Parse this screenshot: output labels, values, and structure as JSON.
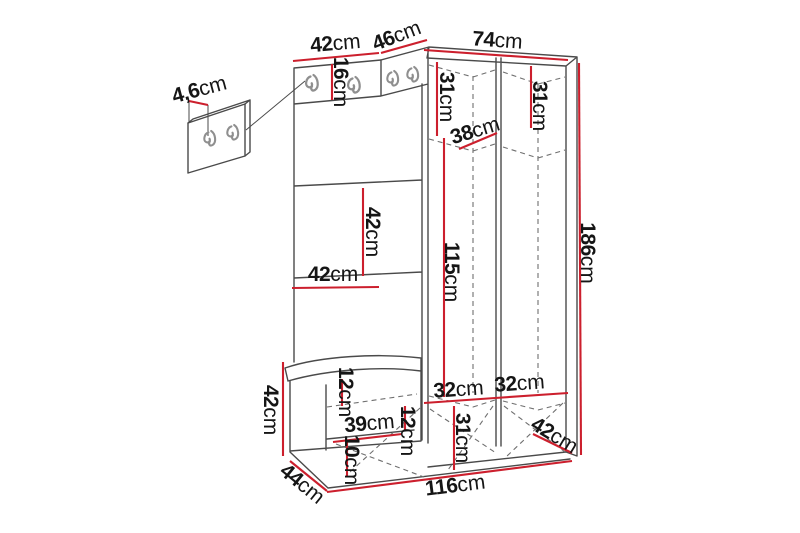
{
  "colors": {
    "dim_line": "#cc1f2d",
    "outline": "#4a4a4a",
    "dashed": "#6f6f6f",
    "hook": "#8f8f8f",
    "text": "#151515",
    "background": "#ffffff"
  },
  "diagram": {
    "type": "furniture-dimension-drawing",
    "subject": "hallway wardrobe set with coat hooks, shelves, bench and wall hook panel",
    "unit": "cm",
    "dims": {
      "top_width_left": {
        "v": "42",
        "u": "cm"
      },
      "top_width_corner": {
        "v": "46",
        "u": "cm"
      },
      "top_width_right": {
        "v": "74",
        "u": "cm"
      },
      "panel_thickness": {
        "v": "4,6",
        "u": "cm"
      },
      "hook_strip_height": {
        "v": "16",
        "u": "cm"
      },
      "upper_section_left": {
        "v": "31",
        "u": "cm"
      },
      "upper_section_right": {
        "v": "31",
        "u": "cm"
      },
      "cabinet_depth": {
        "v": "38",
        "u": "cm"
      },
      "shelf_gap": {
        "v": "42",
        "u": "cm"
      },
      "shelf_width": {
        "v": "42",
        "u": "cm"
      },
      "interior_height": {
        "v": "115",
        "u": "cm"
      },
      "total_height": {
        "v": "186",
        "u": "cm"
      },
      "bench_height": {
        "v": "42",
        "u": "cm"
      },
      "bench_top_gap": {
        "v": "12",
        "u": "cm"
      },
      "bench_inner_width": {
        "v": "39",
        "u": "cm"
      },
      "mid_bottom_gap": {
        "v": "12",
        "u": "cm"
      },
      "bench_lower_gap": {
        "v": "10",
        "u": "cm"
      },
      "bottom_shelf_left": {
        "v": "32",
        "u": "cm"
      },
      "bottom_shelf_right": {
        "v": "32",
        "u": "cm"
      },
      "bottom_section": {
        "v": "31",
        "u": "cm"
      },
      "right_depth": {
        "v": "42",
        "u": "cm"
      },
      "bench_depth": {
        "v": "44",
        "u": "cm"
      },
      "total_width": {
        "v": "116",
        "u": "cm"
      }
    },
    "icons": [
      "coat-hook-icon"
    ]
  }
}
